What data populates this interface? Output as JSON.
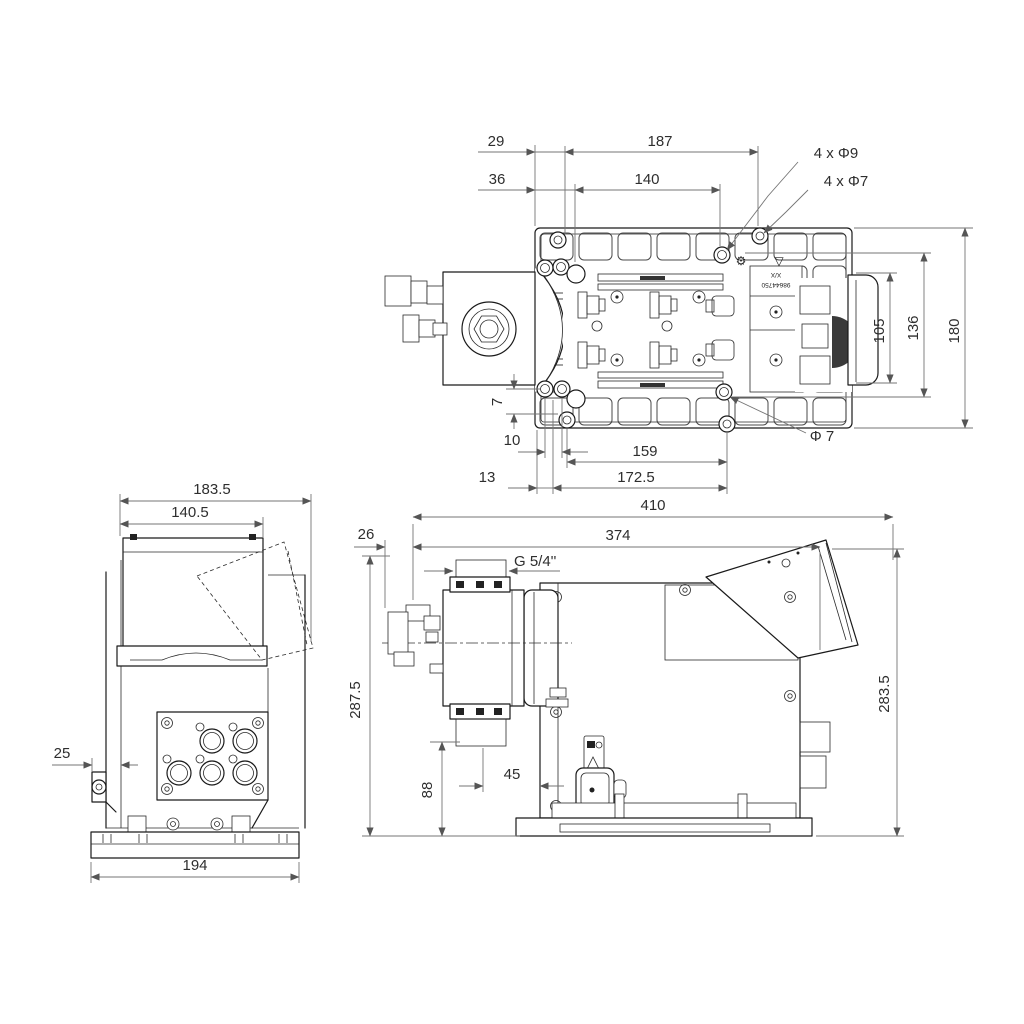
{
  "drawing": {
    "top_view": {
      "d29": "29",
      "d187": "187",
      "d36": "36",
      "d140": "140",
      "holes_9": "4 x Φ9",
      "holes_7": "4 x Φ7",
      "d105": "105",
      "d136": "136",
      "d180": "180",
      "d7": "7",
      "d10": "10",
      "d159": "159",
      "dia7": "Φ 7",
      "d13": "13",
      "d172_5": "172.5",
      "plate_label_top": "X/X",
      "plate_label_bottom": "98644750",
      "gear_icon": "⚙",
      "triangle_icon": "▽"
    },
    "end_view": {
      "d183_5": "183.5",
      "d140_5": "140.5",
      "d25": "25",
      "d194": "194"
    },
    "side_view": {
      "d410": "410",
      "d374": "374",
      "d26": "26",
      "thread": "G 5/4''",
      "d287_5": "287.5",
      "d88": "88",
      "d45": "45",
      "d283_5": "283.5"
    }
  }
}
